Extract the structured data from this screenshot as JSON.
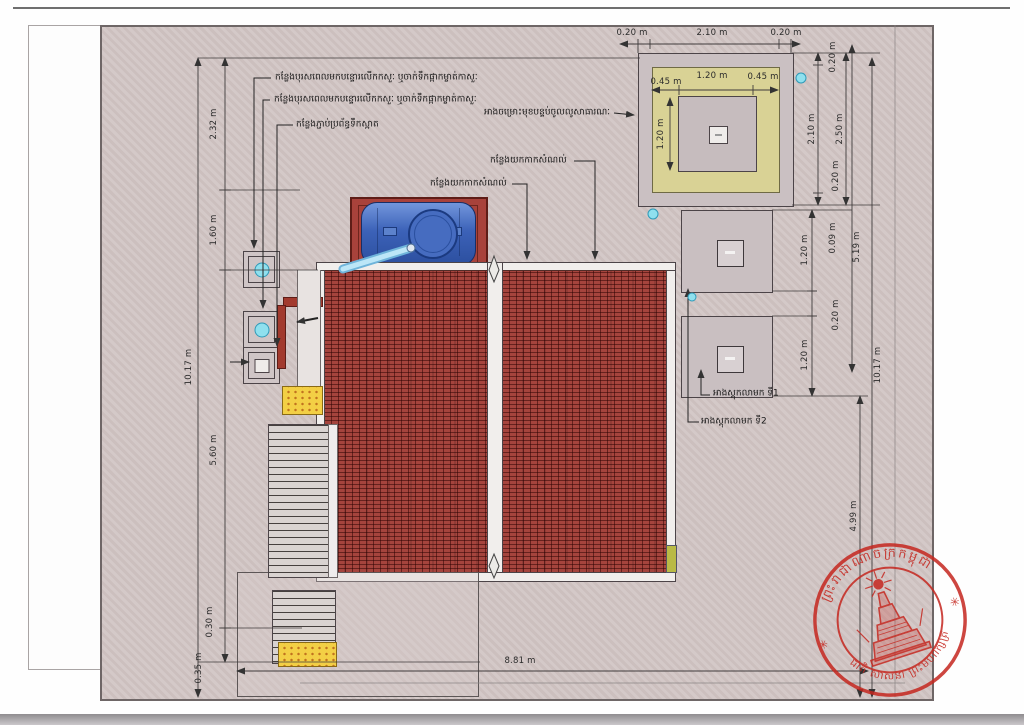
{
  "drawing": {
    "kind": "site-plan",
    "colors": {
      "site_fill": "#d2c6c5",
      "roof_tile": "#a5443d",
      "tank_blue": "#3c62b8",
      "structure_yellow": "#d9d295",
      "tactile_pad_yellow": "#f3cf45",
      "marker_cyan": "#8fe0ee",
      "stamp_red": "#c5271f"
    }
  },
  "dim_labels": [
    {
      "id": "dim-left-232",
      "text": "2.32 m",
      "x": 214,
      "y": 124,
      "r": -90
    },
    {
      "id": "dim-left-160",
      "text": "1.60 m",
      "x": 214,
      "y": 230,
      "r": -90
    },
    {
      "id": "dim-left-1017",
      "text": "10.17 m",
      "x": 189,
      "y": 367,
      "r": -90
    },
    {
      "id": "dim-left-560",
      "text": "5.60 m",
      "x": 214,
      "y": 450,
      "r": -90
    },
    {
      "id": "dim-left-030",
      "text": "0.30 m",
      "x": 210,
      "y": 622,
      "r": -90
    },
    {
      "id": "dim-left-035",
      "text": "0.35 m",
      "x": 199,
      "y": 668,
      "r": -90
    },
    {
      "id": "dim-bottom-881",
      "text": "8.81 m",
      "x": 520,
      "y": 661,
      "r": 0
    },
    {
      "id": "dim-top-020a",
      "text": "0.20 m",
      "x": 632,
      "y": 33,
      "r": 0
    },
    {
      "id": "dim-top-210",
      "text": "2.10 m",
      "x": 712,
      "y": 33,
      "r": 0
    },
    {
      "id": "dim-top-020b",
      "text": "0.20 m",
      "x": 786,
      "y": 33,
      "r": 0
    },
    {
      "id": "dim-in-045a",
      "text": "0.45 m",
      "x": 666,
      "y": 82,
      "r": 0
    },
    {
      "id": "dim-in-120h",
      "text": "1.20 m",
      "x": 712,
      "y": 76,
      "r": 0
    },
    {
      "id": "dim-in-045b",
      "text": "0.45 m",
      "x": 763,
      "y": 77,
      "r": 0
    },
    {
      "id": "dim-in-120v",
      "text": "1.20 m",
      "x": 661,
      "y": 134,
      "r": -90
    },
    {
      "id": "dim-rs-020t",
      "text": "0.20 m",
      "x": 833,
      "y": 57,
      "r": -90
    },
    {
      "id": "dim-rs-210",
      "text": "2.10 m",
      "x": 812,
      "y": 129,
      "r": -90
    },
    {
      "id": "dim-rs-250",
      "text": "2.50 m",
      "x": 840,
      "y": 129,
      "r": -90
    },
    {
      "id": "dim-rs-020b",
      "text": "0.20 m",
      "x": 836,
      "y": 176,
      "r": -90
    },
    {
      "id": "dim-pad-009",
      "text": "0.09 m",
      "x": 833,
      "y": 238,
      "r": -90
    },
    {
      "id": "dim-pad-519",
      "text": "5.19 m",
      "x": 857,
      "y": 247,
      "r": -90
    },
    {
      "id": "dim-pad-120a",
      "text": "1.20 m",
      "x": 805,
      "y": 250,
      "r": -90
    },
    {
      "id": "dim-pad-020",
      "text": "0.20 m",
      "x": 836,
      "y": 315,
      "r": -90
    },
    {
      "id": "dim-pad-120b",
      "text": "1.20 m",
      "x": 805,
      "y": 355,
      "r": -90
    },
    {
      "id": "dim-right-1017",
      "text": "10.17 m",
      "x": 878,
      "y": 365,
      "r": -90
    },
    {
      "id": "dim-right-499",
      "text": "4.99 m",
      "x": 854,
      "y": 516,
      "r": -90
    }
  ],
  "leader_labels": [
    {
      "id": "label-vent-pipe-1",
      "text": "កន្លែងបុរសពេលមកបន្ទោរលើកកសួៈ ឬចាក់ទឹកផ្កាកម្ចាត់កាសួៈ",
      "x": 275,
      "y": 78,
      "anchor": "left"
    },
    {
      "id": "label-vent-pipe-2",
      "text": "កន្លែងបុរសពេលមកបន្ទោរលើកកសួៈ ឬចាក់ទឹកផ្កាកម្ចាត់កាសួៈ",
      "x": 274,
      "y": 100,
      "anchor": "left"
    },
    {
      "id": "label-clean-water",
      "text": "កន្លែងភ្ជាប់ប្រព័ន្ធទឹកស្អាត",
      "x": 296,
      "y": 125,
      "anchor": "left"
    },
    {
      "id": "label-sludge-point-1",
      "text": "កន្លែងយកកាកសំណល់",
      "x": 430,
      "y": 184,
      "anchor": "left"
    },
    {
      "id": "label-sludge-point-2",
      "text": "កន្លែងយកកាកសំណល់",
      "x": 490,
      "y": 161,
      "anchor": "left"
    },
    {
      "id": "label-filter-tank",
      "text": "អាងចម្រោះមុខបន្ទប់ចូលលូសាធារណៈ",
      "x": 610,
      "y": 113,
      "anchor": "right"
    },
    {
      "id": "label-storage-tank-1",
      "text": "អាងស្តុកលាមក ទី1",
      "x": 713,
      "y": 394,
      "anchor": "left"
    },
    {
      "id": "label-storage-tank-2",
      "text": "អាងស្តុកលាមក ទី2",
      "x": 701,
      "y": 422,
      "anchor": "left"
    }
  ],
  "stamp": {
    "arc_top": "ព្រះរាជាណាចក្រកម្ពុជា",
    "arc_bottom": "ជាតិ សាសនា ព្រះមហាក្សត្រ",
    "star_left": "✳",
    "star_right": "✳",
    "color": "#c5271f"
  }
}
